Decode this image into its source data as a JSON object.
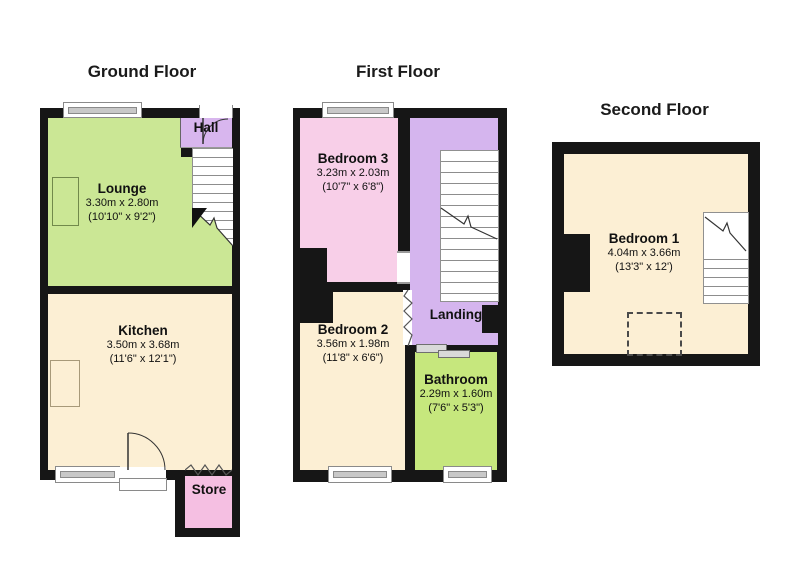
{
  "floors": {
    "ground": {
      "title": "Ground Floor",
      "rooms": {
        "lounge": {
          "name": "Lounge",
          "metric": "3.30m x 2.80m",
          "imperial": "(10'10\" x 9'2\")"
        },
        "kitchen": {
          "name": "Kitchen",
          "metric": "3.50m x 3.68m",
          "imperial": "(11'6\" x 12'1\")"
        },
        "hall": {
          "name": "Hall"
        },
        "store": {
          "name": "Store"
        }
      }
    },
    "first": {
      "title": "First Floor",
      "rooms": {
        "bedroom3": {
          "name": "Bedroom 3",
          "metric": "3.23m x 2.03m",
          "imperial": "(10'7\" x 6'8\")"
        },
        "bedroom2": {
          "name": "Bedroom 2",
          "metric": "3.56m x 1.98m",
          "imperial": "(11'8\" x 6'6\")"
        },
        "landing": {
          "name": "Landing"
        },
        "bathroom": {
          "name": "Bathroom",
          "metric": "2.29m x 1.60m",
          "imperial": "(7'6\" x 5'3\")"
        }
      }
    },
    "second": {
      "title": "Second Floor",
      "rooms": {
        "bedroom1": {
          "name": "Bedroom 1",
          "metric": "4.04m x 3.66m",
          "imperial": "(13'3\" x 12')"
        }
      }
    }
  },
  "colors": {
    "wall": "#161616",
    "lounge_green": "#cbe795",
    "bathroom_green": "#c6e77d",
    "cream": "#fcefd4",
    "lilac": "#d8b6ee",
    "pink_bedroom": "#f8cfe8",
    "pink_store": "#f5bfe2"
  }
}
